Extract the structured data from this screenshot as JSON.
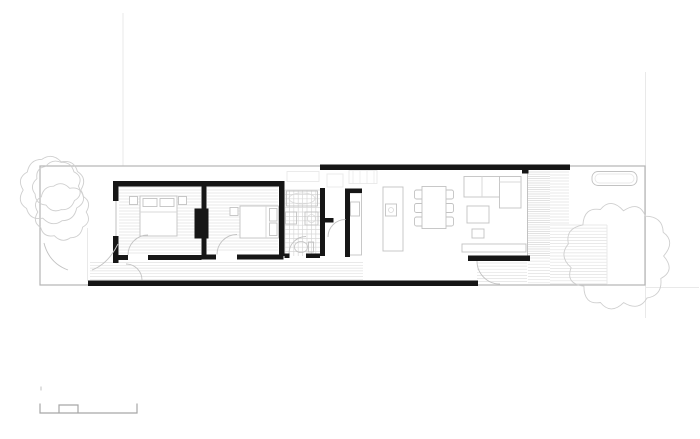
{
  "meta": {
    "description": "Black-and-white architectural floor plan of a long narrow single-storey house on a lot: two bedrooms with wardrobe block, bathroom, hallway, kitchen with island, dining table, living room with sofa, rear timber deck with planter, garden trees, and a graphic scale bar at bottom left",
    "canvas": {
      "width": 700,
      "height": 439,
      "background": "#ffffff"
    }
  },
  "palette": {
    "wall": "#161616",
    "lot": "#b4b4b4",
    "mid": "#c2c2c2",
    "light": "#d8d8d8",
    "hatch": "#e2e2e2",
    "faint": "#e9e9e9",
    "tree": "#cfcfcf",
    "bar": "#a6a6a6"
  },
  "plan": {
    "elements": [
      {
        "t": "line",
        "n": "guide-line-left",
        "x1": 123,
        "y1": 13,
        "x2": 123,
        "y2": 166,
        "c": "faint"
      },
      {
        "t": "line",
        "n": "guide-line-right",
        "x1": 645.5,
        "y1": 72,
        "x2": 645.5,
        "y2": 318,
        "c": "faint"
      },
      {
        "t": "line",
        "n": "guide-line-rear",
        "x1": 645,
        "y1": 287.5,
        "x2": 699,
        "y2": 287.5,
        "c": "faint"
      },
      {
        "t": "line",
        "n": "side-fence-line",
        "x1": 87.5,
        "y1": 228,
        "x2": 87.5,
        "y2": 281,
        "c": "faint"
      },
      {
        "t": "hatch",
        "n": "bedroom-1-floor-boards",
        "x": 119,
        "y": 187,
        "w": 82,
        "h": 67,
        "s": 3,
        "c": "hatch"
      },
      {
        "t": "hatch",
        "n": "bedroom-2-floor-boards",
        "x": 207,
        "y": 187,
        "w": 71,
        "h": 65,
        "s": 3,
        "c": "hatch"
      },
      {
        "t": "hatch",
        "n": "hallway-floor-boards",
        "x": 90,
        "y": 262.5,
        "w": 273,
        "h": 17,
        "s": 2.8,
        "c": "hatch"
      },
      {
        "t": "grid",
        "n": "bathroom-tile-floor",
        "x": 285,
        "y": 190,
        "w": 35,
        "h": 66,
        "s": 4.4,
        "c": "light"
      },
      {
        "t": "hatch",
        "n": "deck-boards-side",
        "x": 528,
        "y": 172,
        "w": 22,
        "h": 85,
        "s": 2.2,
        "c": "light"
      },
      {
        "t": "hatch",
        "n": "deck-boards-side-2",
        "x": 550,
        "y": 172,
        "w": 19,
        "h": 53,
        "s": 3,
        "c": "hatch"
      },
      {
        "t": "hatch",
        "n": "deck-boards-main",
        "x": 550,
        "y": 225,
        "w": 57,
        "h": 59,
        "s": 3.1,
        "c": "hatch"
      },
      {
        "t": "hatch",
        "n": "deck-boards-lower",
        "x": 528,
        "y": 258,
        "w": 22,
        "h": 26,
        "s": 3.1,
        "c": "hatch"
      },
      {
        "t": "hatch",
        "n": "patio-boards",
        "x": 477,
        "y": 263,
        "w": 50,
        "h": 21,
        "s": 3.1,
        "c": "hatch"
      },
      {
        "t": "line",
        "n": "deck-edge",
        "x1": 607,
        "y1": 225,
        "x2": 607,
        "y2": 284,
        "c": "faint"
      },
      {
        "t": "rect-stroke",
        "n": "lot-boundary",
        "x": 40,
        "y": 166,
        "w": 605,
        "h": 119,
        "c": "lot",
        "sw": 1.2
      },
      {
        "t": "line",
        "n": "living-glass-wall",
        "x1": 527.5,
        "y1": 170,
        "x2": 527.5,
        "y2": 257,
        "c": "mid"
      },
      {
        "t": "rect-stroke",
        "n": "skylight-bathroom",
        "x": 287,
        "y": 171.5,
        "w": 32,
        "h": 10,
        "c": "faint"
      },
      {
        "t": "rect-stroke",
        "n": "skylight-hall",
        "x": 327,
        "y": 174,
        "w": 16,
        "h": 13,
        "c": "faint"
      },
      {
        "t": "rect-stroke",
        "n": "skylight-kitchen",
        "x": 349,
        "y": 170.5,
        "w": 28,
        "h": 13,
        "c": "faint"
      },
      {
        "t": "hatch",
        "n": "skylight-kitchen-louvres",
        "dir": "v",
        "x": 353,
        "y": 171,
        "w": 21,
        "h": 12.5,
        "s": 7,
        "c": "faint"
      },
      {
        "t": "rect",
        "n": "nightstand",
        "x": 129.5,
        "y": 196.5,
        "w": 8,
        "h": 8
      },
      {
        "t": "rect",
        "n": "nightstand",
        "x": 178.5,
        "y": 196.5,
        "w": 8,
        "h": 8
      },
      {
        "t": "rect",
        "n": "bed-1",
        "x": 140,
        "y": 196,
        "w": 37,
        "h": 40
      },
      {
        "t": "rect",
        "n": "pillow",
        "x": 143,
        "y": 198.5,
        "w": 14,
        "h": 8
      },
      {
        "t": "rect",
        "n": "pillow",
        "x": 160,
        "y": 198.5,
        "w": 14,
        "h": 8
      },
      {
        "t": "line",
        "n": "bed-1-fold-line",
        "x1": 140,
        "y1": 212,
        "x2": 177,
        "y2": 212,
        "c": "light"
      },
      {
        "t": "rect",
        "n": "nightstand",
        "x": 230,
        "y": 207.5,
        "w": 8,
        "h": 8
      },
      {
        "t": "rect",
        "n": "bed-2",
        "x": 240,
        "y": 206,
        "w": 38.5,
        "h": 32
      },
      {
        "t": "rect",
        "n": "pillow",
        "x": 269.5,
        "y": 208.5,
        "w": 7.5,
        "h": 12.5
      },
      {
        "t": "rect",
        "n": "pillow",
        "x": 269.5,
        "y": 223,
        "w": 7.5,
        "h": 12.5
      },
      {
        "t": "line",
        "n": "bed-2-fold-line",
        "x1": 266,
        "y1": 206,
        "x2": 266,
        "y2": 238,
        "c": "light"
      },
      {
        "t": "rect-stroke",
        "n": "bathtub",
        "x": 286.5,
        "y": 191,
        "w": 31,
        "h": 15,
        "c": "mid"
      },
      {
        "t": "ellipse",
        "n": "bathtub-basin",
        "cx": 302,
        "cy": 198.5,
        "rx": 13,
        "ry": 5.5,
        "c": "light"
      },
      {
        "t": "rect-stroke",
        "n": "washbasin",
        "x": 285.5,
        "y": 212,
        "w": 11,
        "h": 12,
        "c": "mid"
      },
      {
        "t": "rect-stroke",
        "n": "washing-machine",
        "x": 305,
        "y": 212,
        "w": 13,
        "h": 13,
        "c": "mid"
      },
      {
        "t": "circle",
        "n": "washing-machine-drum",
        "cx": 311.5,
        "cy": 218.5,
        "r": 4,
        "c": "light"
      },
      {
        "t": "ellipse",
        "n": "toilet-bowl",
        "cx": 301,
        "cy": 247,
        "rx": 6.5,
        "ry": 5.5,
        "c": "mid"
      },
      {
        "t": "rect-stroke",
        "n": "toilet-tank",
        "x": 308.5,
        "y": 242,
        "w": 5,
        "h": 10,
        "c": "mid"
      },
      {
        "t": "rect",
        "n": "kitchen-counter",
        "x": 348.5,
        "y": 193,
        "w": 13,
        "h": 62
      },
      {
        "t": "rect-stroke",
        "n": "kitchen-sink",
        "x": 350.5,
        "y": 202,
        "w": 9,
        "h": 14,
        "c": "mid"
      },
      {
        "t": "rect",
        "n": "kitchen-island",
        "x": 383,
        "y": 187,
        "w": 20,
        "h": 64
      },
      {
        "t": "rect-stroke",
        "n": "cooktop",
        "x": 385.5,
        "y": 204,
        "w": 11,
        "h": 12,
        "c": "mid"
      },
      {
        "t": "circle",
        "n": "cooktop-burner",
        "cx": 391,
        "cy": 210,
        "r": 2.5,
        "c": "light"
      },
      {
        "t": "rect-stroke",
        "n": "dining-chair",
        "x": 414.5,
        "y": 190,
        "w": 9,
        "h": 9,
        "rx": 2,
        "c": "mid"
      },
      {
        "t": "rect-stroke",
        "n": "dining-chair",
        "x": 414.5,
        "y": 203.5,
        "w": 9,
        "h": 9,
        "rx": 2,
        "c": "mid"
      },
      {
        "t": "rect-stroke",
        "n": "dining-chair",
        "x": 414.5,
        "y": 217,
        "w": 9,
        "h": 9,
        "rx": 2,
        "c": "mid"
      },
      {
        "t": "rect-stroke",
        "n": "dining-chair",
        "x": 444.5,
        "y": 190,
        "w": 9,
        "h": 9,
        "rx": 2,
        "c": "mid"
      },
      {
        "t": "rect-stroke",
        "n": "dining-chair",
        "x": 444.5,
        "y": 203.5,
        "w": 9,
        "h": 9,
        "rx": 2,
        "c": "mid"
      },
      {
        "t": "rect-stroke",
        "n": "dining-chair",
        "x": 444.5,
        "y": 217,
        "w": 9,
        "h": 9,
        "rx": 2,
        "c": "mid"
      },
      {
        "t": "rect",
        "n": "dining-table",
        "x": 422,
        "y": 186.5,
        "w": 24,
        "h": 42
      },
      {
        "t": "rect",
        "n": "sofa",
        "x": 464,
        "y": 176.5,
        "w": 57,
        "h": 20.5
      },
      {
        "t": "rect",
        "n": "sofa-chaise",
        "x": 499.5,
        "y": 176.5,
        "w": 21.5,
        "h": 31.5
      },
      {
        "t": "line",
        "n": "sofa-cushion-line",
        "x1": 482,
        "y1": 176.5,
        "x2": 482,
        "y2": 197,
        "c": "light"
      },
      {
        "t": "line",
        "n": "sofa-cushion-line",
        "x1": 499.5,
        "y1": 182,
        "x2": 521,
        "y2": 182,
        "c": "light"
      },
      {
        "t": "rect",
        "n": "coffee-table",
        "x": 467,
        "y": 206,
        "w": 22,
        "h": 17
      },
      {
        "t": "rect",
        "n": "pouf",
        "x": 472,
        "y": 229,
        "w": 12,
        "h": 9
      },
      {
        "t": "rect",
        "n": "tv-bench",
        "x": 462,
        "y": 244,
        "w": 64,
        "h": 8
      },
      {
        "t": "rect-stroke",
        "n": "deck-planter",
        "x": 592,
        "y": 171.5,
        "w": 45,
        "h": 14,
        "rx": 6,
        "c": "mid"
      },
      {
        "t": "rect-stroke",
        "n": "deck-planter-inner",
        "x": 595,
        "y": 174,
        "w": 39,
        "h": 9,
        "rx": 4.5,
        "c": "faint"
      },
      {
        "t": "line",
        "n": "bedroom-1-window-glazing",
        "x1": 116,
        "y1": 201,
        "x2": 116,
        "y2": 236,
        "c": "mid"
      },
      {
        "t": "wall",
        "n": "bedroom-top-wall",
        "x": 113,
        "y": 181,
        "w": 171.5,
        "h": 5.5
      },
      {
        "t": "wall",
        "n": "west-wall-upper",
        "x": 113,
        "y": 181,
        "w": 5.5,
        "h": 20
      },
      {
        "t": "wall",
        "n": "west-wall-lower",
        "x": 113,
        "y": 236,
        "w": 5.5,
        "h": 27
      },
      {
        "t": "wall",
        "n": "bedroom-divider-wall-upper",
        "x": 201.5,
        "y": 186.5,
        "w": 5,
        "h": 22
      },
      {
        "t": "wall",
        "n": "bedroom-divider-wall-lower",
        "x": 201.5,
        "y": 238,
        "w": 5,
        "h": 18
      },
      {
        "t": "wall",
        "n": "wardrobe-block",
        "x": 194.5,
        "y": 208.5,
        "w": 14,
        "h": 30
      },
      {
        "t": "wall",
        "n": "bedroom-2-east-wall",
        "x": 279,
        "y": 181,
        "w": 5.5,
        "h": 75
      },
      {
        "t": "wall",
        "n": "bedroom-1-door-jamb-wall",
        "x": 113,
        "y": 255,
        "w": 15,
        "h": 5
      },
      {
        "t": "wall",
        "n": "bedroom-1-south-wall",
        "x": 148,
        "y": 255,
        "w": 53.5,
        "h": 5
      },
      {
        "t": "wall",
        "n": "bedroom-2-door-jamb-wall",
        "x": 201.5,
        "y": 254.5,
        "w": 14.5,
        "h": 5
      },
      {
        "t": "wall",
        "n": "bedroom-2-south-wall",
        "x": 237,
        "y": 254.5,
        "w": 46.5,
        "h": 5
      },
      {
        "t": "wall",
        "n": "bathroom-south-wall-west",
        "x": 284.5,
        "y": 253.5,
        "w": 5,
        "h": 4.5
      },
      {
        "t": "wall",
        "n": "bathroom-south-wall-east",
        "x": 306,
        "y": 253.5,
        "w": 14,
        "h": 4.5
      },
      {
        "t": "wall",
        "n": "bathroom-east-wall",
        "x": 320,
        "y": 188,
        "w": 5,
        "h": 68
      },
      {
        "t": "wall",
        "n": "bathroom-wall-stub",
        "x": 325,
        "y": 218,
        "w": 8.5,
        "h": 4.5
      },
      {
        "t": "wall",
        "n": "kitchen-west-wall",
        "x": 345,
        "y": 188.5,
        "w": 5,
        "h": 68.5
      },
      {
        "t": "wall",
        "n": "kitchen-wall-stub",
        "x": 345,
        "y": 188.5,
        "w": 17,
        "h": 4.5
      },
      {
        "t": "wall",
        "n": "living-top-wall",
        "x": 320,
        "y": 164.5,
        "w": 250,
        "h": 5.5
      },
      {
        "t": "wall",
        "n": "top-wall-column",
        "x": 522,
        "y": 170,
        "w": 6.5,
        "h": 3.5
      },
      {
        "t": "wall",
        "n": "living-south-wall",
        "x": 468,
        "y": 255.5,
        "w": 62,
        "h": 5.5
      },
      {
        "t": "wall",
        "n": "south-outer-wall",
        "x": 88,
        "y": 280.5,
        "w": 390,
        "h": 5.5
      },
      {
        "t": "path",
        "n": "bedroom-1-door-swing",
        "d": "M128,255 A20,20 0 0 1 148,235",
        "c": "mid"
      },
      {
        "t": "path",
        "n": "bedroom-2-door-swing",
        "d": "M217,254.5 A20,20 0 0 1 237,234.5",
        "c": "mid"
      },
      {
        "t": "path",
        "n": "entry-door-swing",
        "d": "M142,280 A16,16 0 0 0 126,264",
        "c": "mid"
      },
      {
        "t": "path",
        "n": "hall-door-swing",
        "d": "M328,237 A17.5,17.5 0 0 1 345.5,219.5",
        "c": "mid"
      },
      {
        "t": "path",
        "n": "bathroom-door-swing",
        "d": "M289,253.5 A17,17 0 0 1 306,236.5",
        "c": "mid"
      },
      {
        "t": "path",
        "n": "terrace-door-swing",
        "d": "M477,261 A23,23 0 0 0 500,284",
        "c": "mid"
      },
      {
        "t": "path",
        "n": "garden-path-arc",
        "d": "M44,243 Q49,263 68,270",
        "c": "mid"
      },
      {
        "t": "path",
        "n": "garden-path-arc",
        "d": "M118,244 Q108,264 92,270",
        "c": "mid"
      },
      {
        "t": "tree",
        "n": "tree-canopy-outline",
        "cx": 52,
        "cy": 190,
        "r": 31,
        "bumps": 10,
        "c": "tree"
      },
      {
        "t": "tree",
        "n": "tree-front-yard-small",
        "cx": 57,
        "cy": 186,
        "r": 23,
        "bumps": 9,
        "c": "tree"
      },
      {
        "t": "tree",
        "n": "tree-front-yard-large",
        "cx": 62,
        "cy": 212,
        "r": 26,
        "bumps": 10,
        "c": "tree"
      },
      {
        "t": "tree",
        "n": "tree-back-yard",
        "cx": 618,
        "cy": 256,
        "r": 49,
        "bumps": 13,
        "c": "tree"
      },
      {
        "t": "path",
        "n": "scale-bar",
        "d": "M40,403.5 L40,413 L137,413 L137,403.5 M59,413 L59,405 L78,405 L78,413",
        "c": "bar",
        "sw": 1.2
      },
      {
        "t": "line",
        "n": "scale-bar-tick",
        "x1": 41,
        "y1": 386.5,
        "x2": 41,
        "y2": 390.5,
        "c": "mid"
      }
    ]
  }
}
